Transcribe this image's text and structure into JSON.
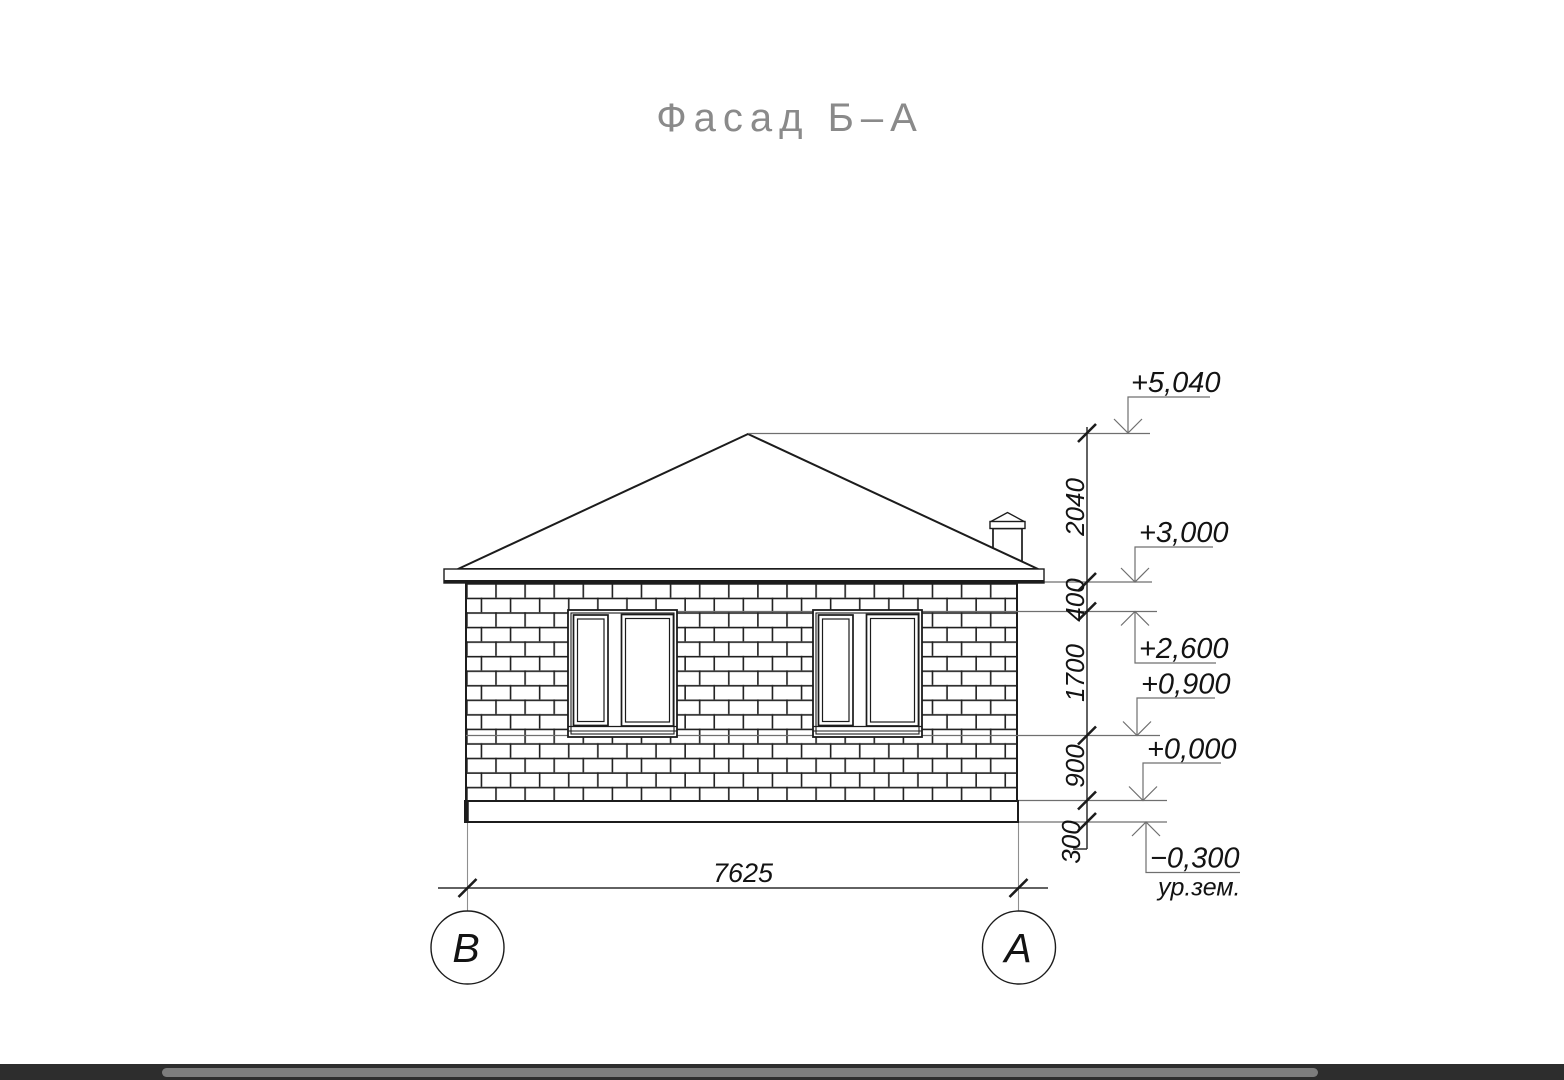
{
  "drawing": {
    "title": "Фасад Б–А"
  },
  "levels": {
    "l5040": "+5,040",
    "l3000": "+3,000",
    "l2600": "+2,600",
    "l0900": "+0,900",
    "l0000": "+0,000",
    "lm0300": "−0,300",
    "ground": "ур.зем."
  },
  "dimensions": {
    "v2040": "2040",
    "v400": "400",
    "v1700": "1700",
    "v900": "900",
    "v300": "300",
    "width": "7625"
  },
  "axes": {
    "left": "В",
    "right": "А"
  },
  "colors": {
    "line": "#1c1c1c",
    "extension_line": "#8f8f8f",
    "title_text": "#8a8a8a",
    "scrollbar_track": "#2d2d2d",
    "scrollbar_thumb": "#7d7d7d"
  }
}
